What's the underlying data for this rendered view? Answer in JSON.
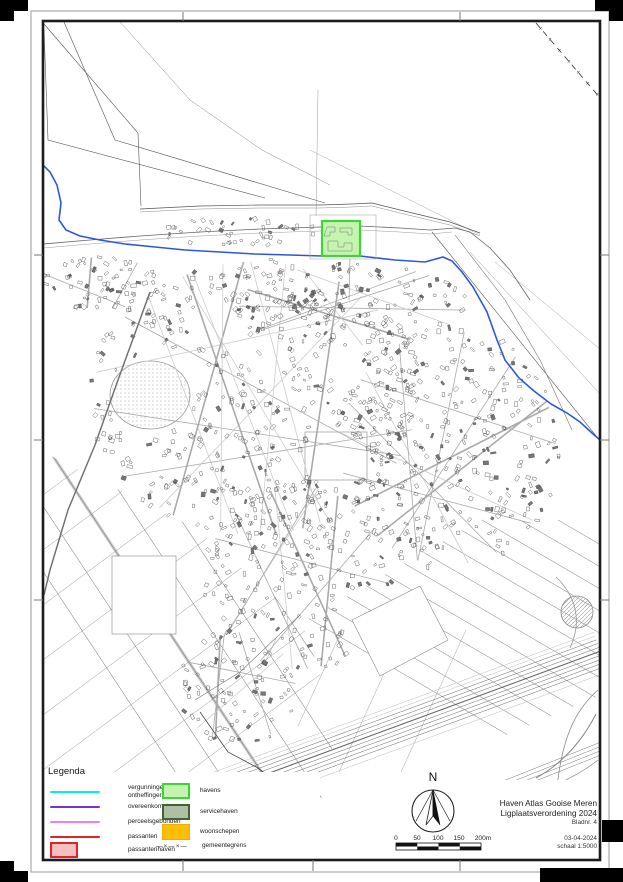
{
  "legend": {
    "title": "Legenda",
    "line_items": [
      {
        "label": "vergunningen / ontheffingen",
        "color": "#00f0f0",
        "style": "line"
      },
      {
        "label": "overeenkomsten",
        "color": "#7b2fd6",
        "style": "line"
      },
      {
        "label": "perceelsgebonden",
        "color": "#f07ef0",
        "style": "line"
      },
      {
        "label": "passanten",
        "color": "#e32222",
        "style": "line"
      },
      {
        "label": "passantenhaven",
        "fill": "#f7bfbf",
        "border": "#e32222",
        "style": "rect"
      }
    ],
    "area_items": [
      {
        "label": "havens",
        "fill": "#c4f4ae",
        "border": "#3cd63c"
      },
      {
        "label": "servicehaven",
        "fill": "#afbfa5",
        "border": "#44622f"
      },
      {
        "label": "woonschepen",
        "fill": "#ffbe0a"
      },
      {
        "label": "gemeentegrens",
        "symbol": "—×—×—"
      }
    ]
  },
  "title_block": {
    "line1": "Haven Atlas Gooise Meren",
    "line2": "Ligplaatsverordening 2024",
    "line3": "Bladnr. 4",
    "date": "03-04-2024",
    "scale": "schaal 1:5000"
  },
  "north_arrow": {
    "label": "N"
  },
  "scale_bar": {
    "ticks": [
      "0",
      "50",
      "100",
      "150",
      "200m"
    ]
  },
  "map": {
    "feature_colors": {
      "water": "#2e57d8",
      "haven_highlight_fill": "#c4f4ae",
      "haven_highlight_border": "#3cd63c",
      "municipal_boundary": "#333333"
    }
  }
}
